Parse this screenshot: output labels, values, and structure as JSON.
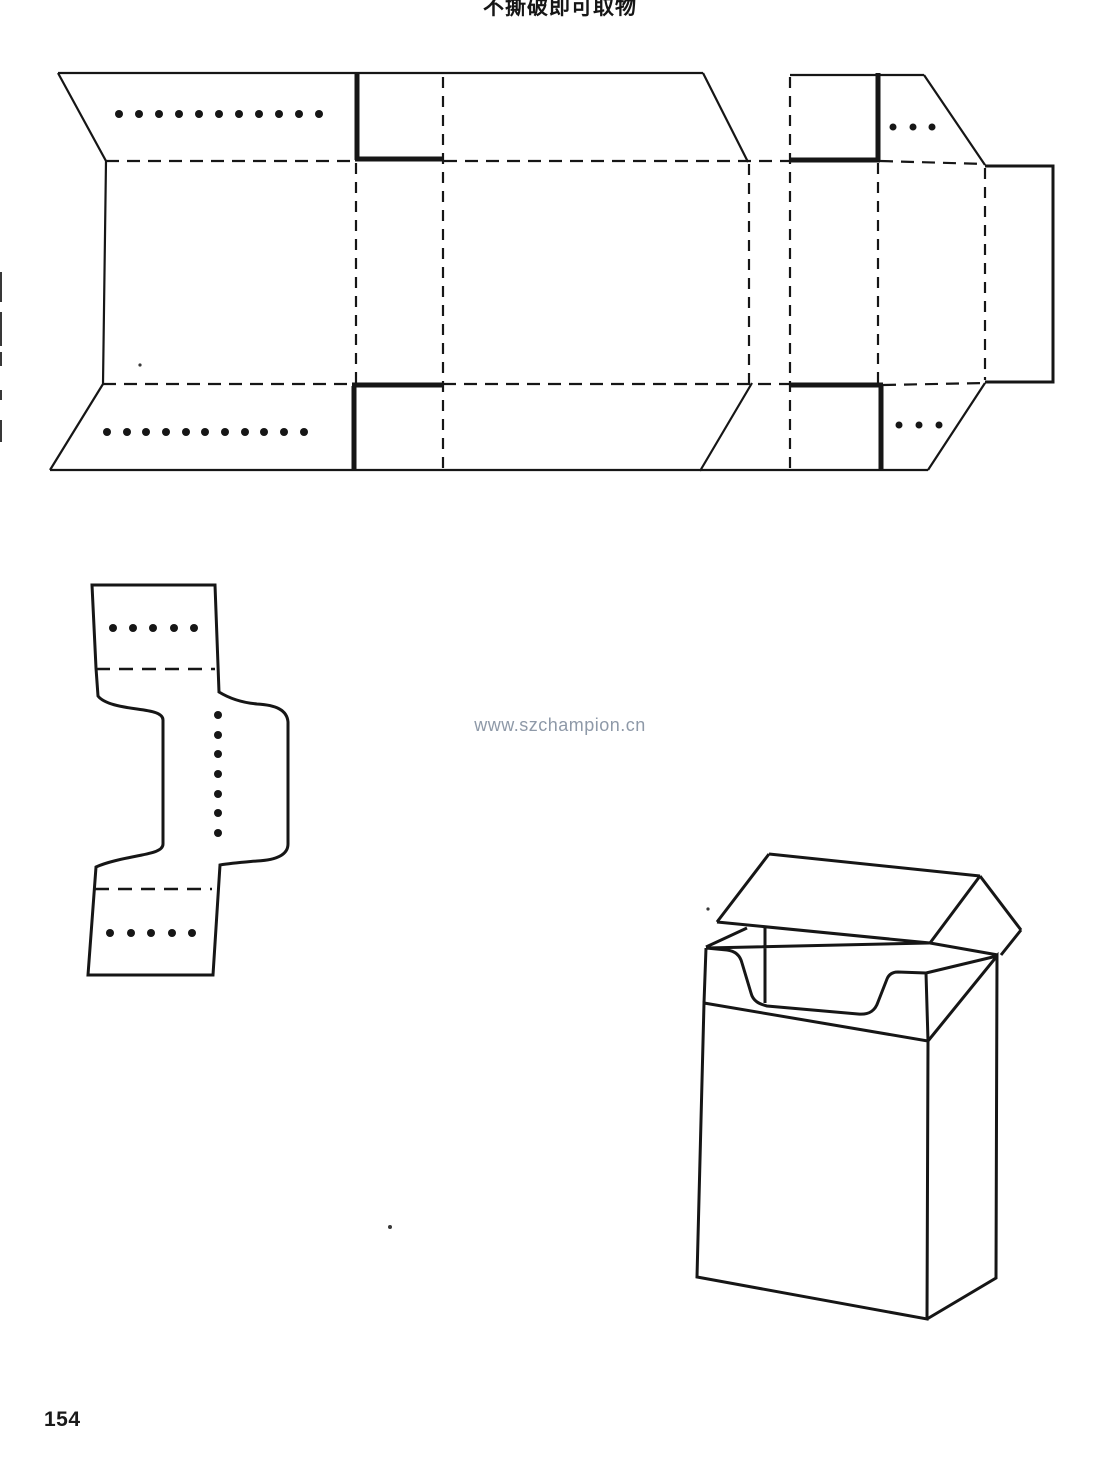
{
  "page": {
    "title": "不撕破即可取物",
    "watermark": "www.szchampion.cn",
    "page_number": "154"
  },
  "colors": {
    "ink": "#161616",
    "paper": "#ffffff",
    "watermark_gray_blue": "#8e99a8"
  },
  "figure_semantics": {
    "top_figure": "flat-box-dieline-with-tear-slots",
    "middle_left_figure": "inner-frame-dieline",
    "bottom_right_figure": "assembled-open-box"
  }
}
